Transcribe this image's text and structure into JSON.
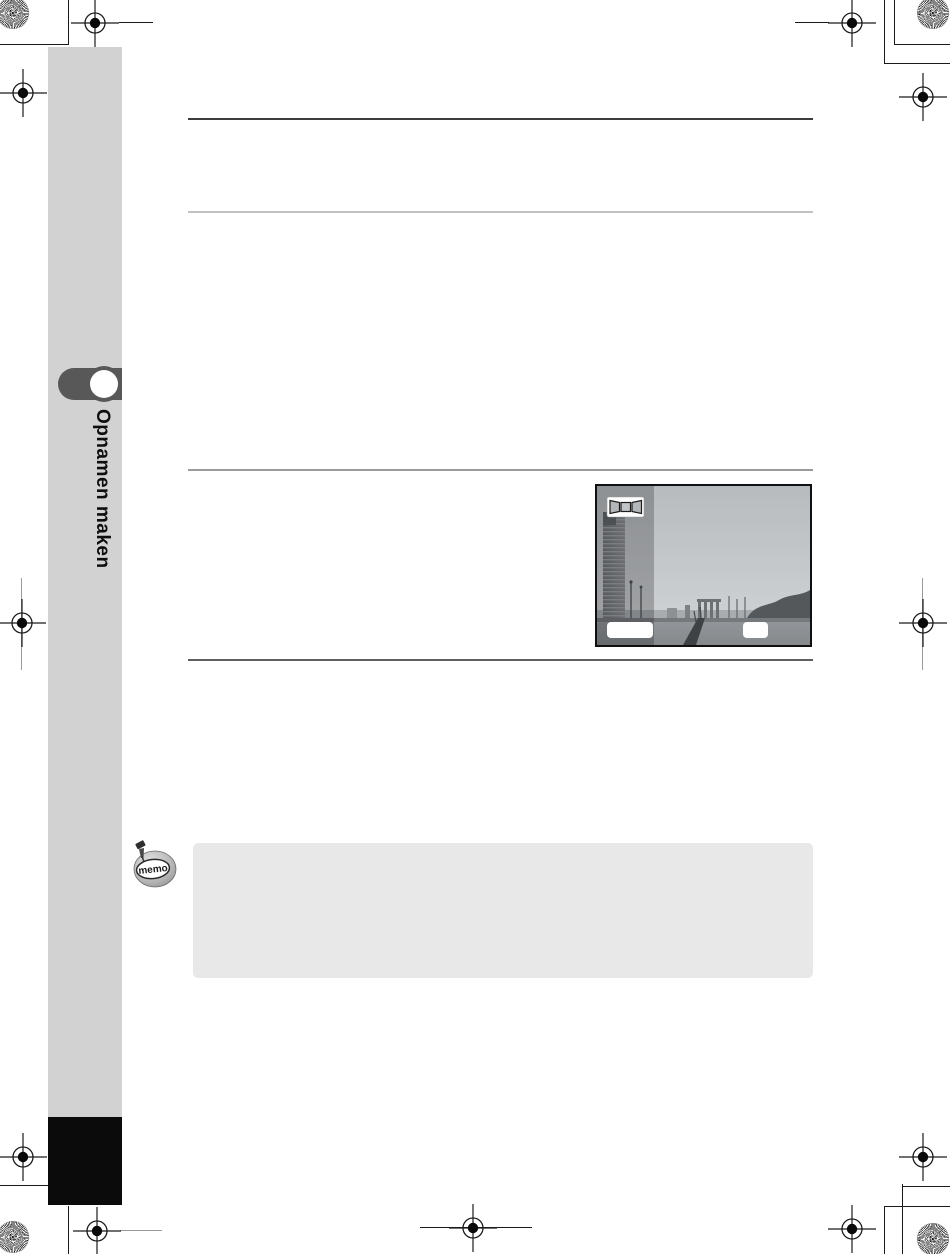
{
  "sidebar": {
    "chapter_label": "Opnamen maken"
  },
  "memo": {
    "icon_text": "memo"
  },
  "figure": {
    "mode_icon": "panorama-filmstrip-icon",
    "left_button_label": "",
    "right_button_label": ""
  },
  "colors": {
    "sidebar_bg": "#d2d2d2",
    "chapter_tab": "#585858",
    "footer_block": "#0b0b0b",
    "memo_box_bg": "#e8e8e8",
    "rule_dark": "#3c3c3c",
    "rule_light": "#c2c2c2"
  }
}
